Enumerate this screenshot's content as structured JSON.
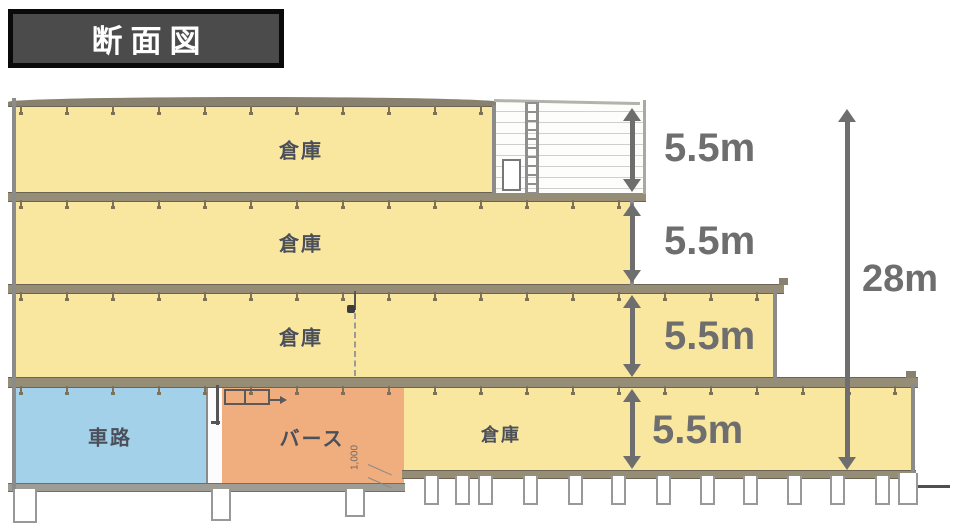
{
  "title": "断面図",
  "floors": {
    "level4": {
      "label": "倉庫",
      "height": "5.5m"
    },
    "level3": {
      "label": "倉庫",
      "height": "5.5m"
    },
    "level2": {
      "label": "倉庫",
      "height": "5.5m"
    },
    "level1": {
      "road": "車路",
      "berth": "バース",
      "warehouse": "倉庫",
      "height": "5.5m"
    }
  },
  "total_height": "28m",
  "dock_step_dimension": "1,000",
  "colors": {
    "warehouse_fill": "#f9e7a0",
    "road_fill": "#a4d1ea",
    "berth_fill": "#f0ad7d",
    "slab": "#968d77",
    "dimension_gray": "#6e6e6e",
    "label_text": "#4a4f5a",
    "title_bg": "#4b4b4b",
    "title_text": "#ffffff"
  }
}
